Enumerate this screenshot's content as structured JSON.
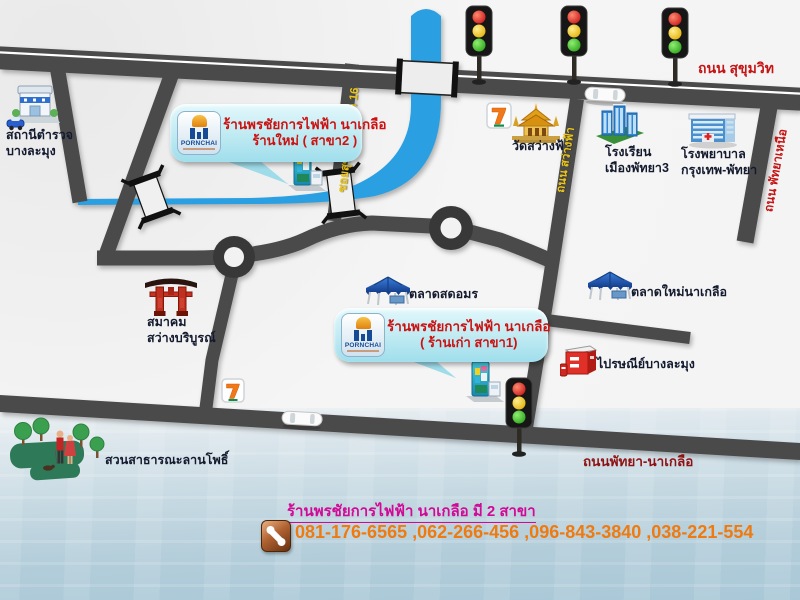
{
  "map": {
    "road_labels": {
      "sukhumvit": "ถนน สุขุมวิท",
      "soi_sukhumvit_16": "ซอยสุขุมวิท พัทยา 16",
      "sawang_fa": "ถนน สว่างฟ้า",
      "pattaya_nuea": "ถนน พัทยาเหนือ",
      "pattaya_naklua": "ถนนพัทยา-นาเกลือ"
    },
    "places": {
      "police": {
        "line1": "สถานีตำรวจ",
        "line2": "บางละมุง"
      },
      "temple": {
        "line1": "วัดสว่างฟ้า"
      },
      "school": {
        "line1": "โรงเรียน",
        "line2": "เมืองพัทยา3"
      },
      "hospital": {
        "line1": "โรงพยาบาล",
        "line2": "กรุงเทพ-พัทยา"
      },
      "shrine": {
        "line1": "สมาคม",
        "line2": "สว่างบริบูรณ์"
      },
      "market_amon": {
        "line1": "ตลาดสดอมร"
      },
      "market_new": {
        "line1": "ตลาดใหม่นาเกลือ"
      },
      "post_office": {
        "line1": "ไปรษณีย์บางละมุง"
      },
      "park": {
        "line1": "สวนสาธารณะลานโพธิ์"
      }
    },
    "callouts": {
      "new_branch": {
        "logo": "PORNCHAI",
        "line1": "ร้านพรชัยการไฟฟ้า นาเกลือ",
        "line2": "ร้านใหม่ ( สาขา2 )"
      },
      "old_branch": {
        "logo": "PORNCHAI",
        "line1": "ร้านพรชัยการไฟฟ้า นาเกลือ",
        "line2": "( ร้านเก่า สาขา1)"
      }
    },
    "footer": {
      "title": "ร้านพรชัยการไฟฟ้า นาเกลือ มี  2 สาขา",
      "phones": "081-176-6565 ,062-266-456 ,096-843-3840 ,038-221-554"
    },
    "colors": {
      "road": "#4a4a4a",
      "canal": "#2aa0e2",
      "label_red": "#c41414",
      "label_dark_red": "#8e1212",
      "label_yellow": "#e9c51d",
      "title_magenta": "#d10a96",
      "phone_orange": "#ee7a10",
      "callout_bg": "#bfeaf2"
    }
  }
}
